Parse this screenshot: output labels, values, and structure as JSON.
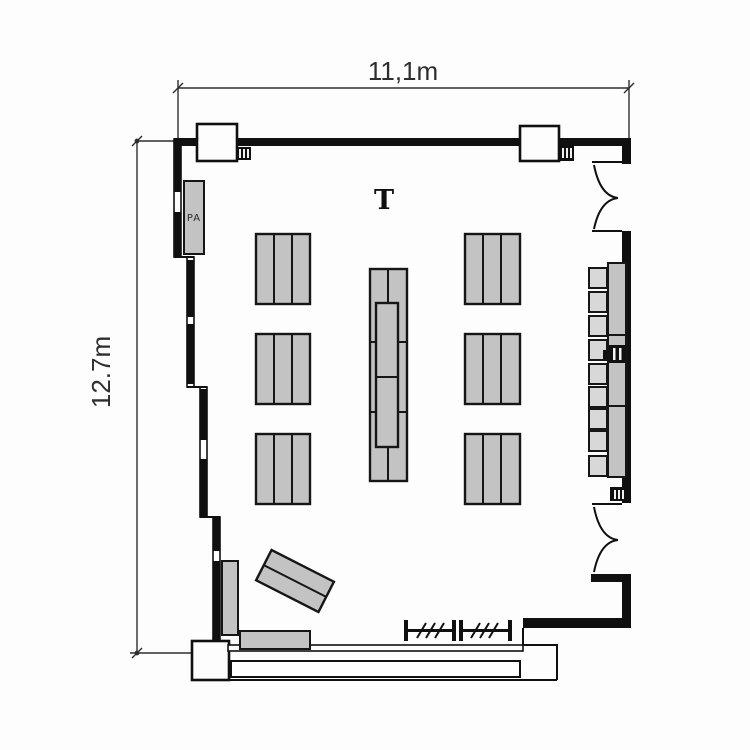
{
  "drawing_type": "architectural room floor plan",
  "room": {
    "width_label": "11,1m",
    "height_label": "12.7m"
  },
  "equipment": {
    "pa_label": "PA",
    "projector_glyph": "T"
  },
  "inventory": {
    "triple_section_tables": 6,
    "center_table_segments": 4,
    "right_wall_bench_segments": 3,
    "right_wall_chairs": 9,
    "door_openings_right_wall": 2,
    "columns_on_top_wall": 2,
    "coat_rack_units": 2,
    "angled_table_sections": 2,
    "windows_left_wall": 4
  },
  "colors": {
    "background": "#fdfdfd",
    "wall": "#101010",
    "furniture_fill": "#c3c3c3",
    "chair_fill": "#d8d8d8",
    "dimension_line": "#2e2e2e"
  }
}
